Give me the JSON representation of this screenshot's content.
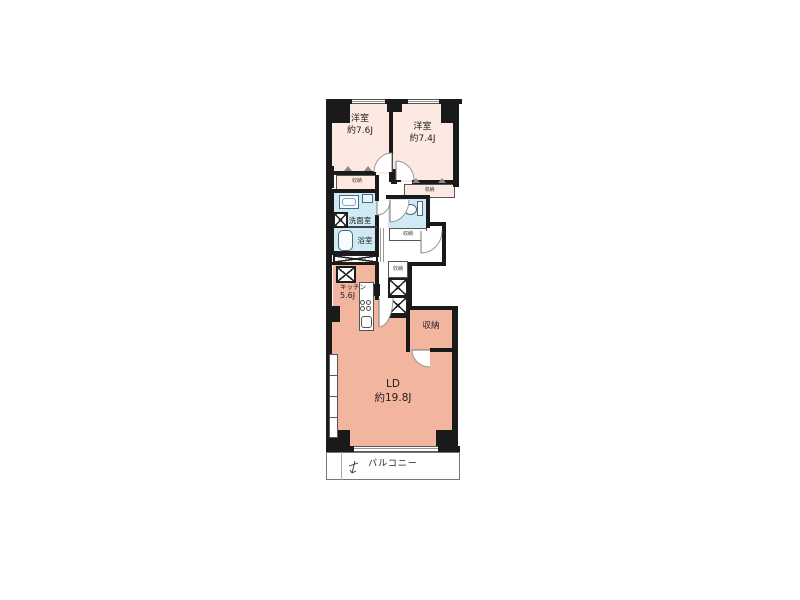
{
  "plan": {
    "rooms": {
      "bedroom_left": {
        "name": "洋室",
        "size": "約7.6J"
      },
      "bedroom_right": {
        "name": "洋室",
        "size": "約7.4J"
      },
      "washroom": {
        "name": "洗面室"
      },
      "bathroom": {
        "name": "浴室"
      },
      "kitchen": {
        "name": "キッチン",
        "size": "5.6J"
      },
      "storage": {
        "name": "収納"
      },
      "living_dining": {
        "name": "LD",
        "size": "約19.8J"
      },
      "balcony": {
        "name": "バルコニー"
      },
      "closet": {
        "name": "収納"
      }
    },
    "colors": {
      "wall": "#1a1a1a",
      "bedroom_fill": "#fce9e1",
      "living_fill": "#f2b59d",
      "wet_area_fill": "#cfeaf4",
      "background": "#ffffff"
    }
  }
}
